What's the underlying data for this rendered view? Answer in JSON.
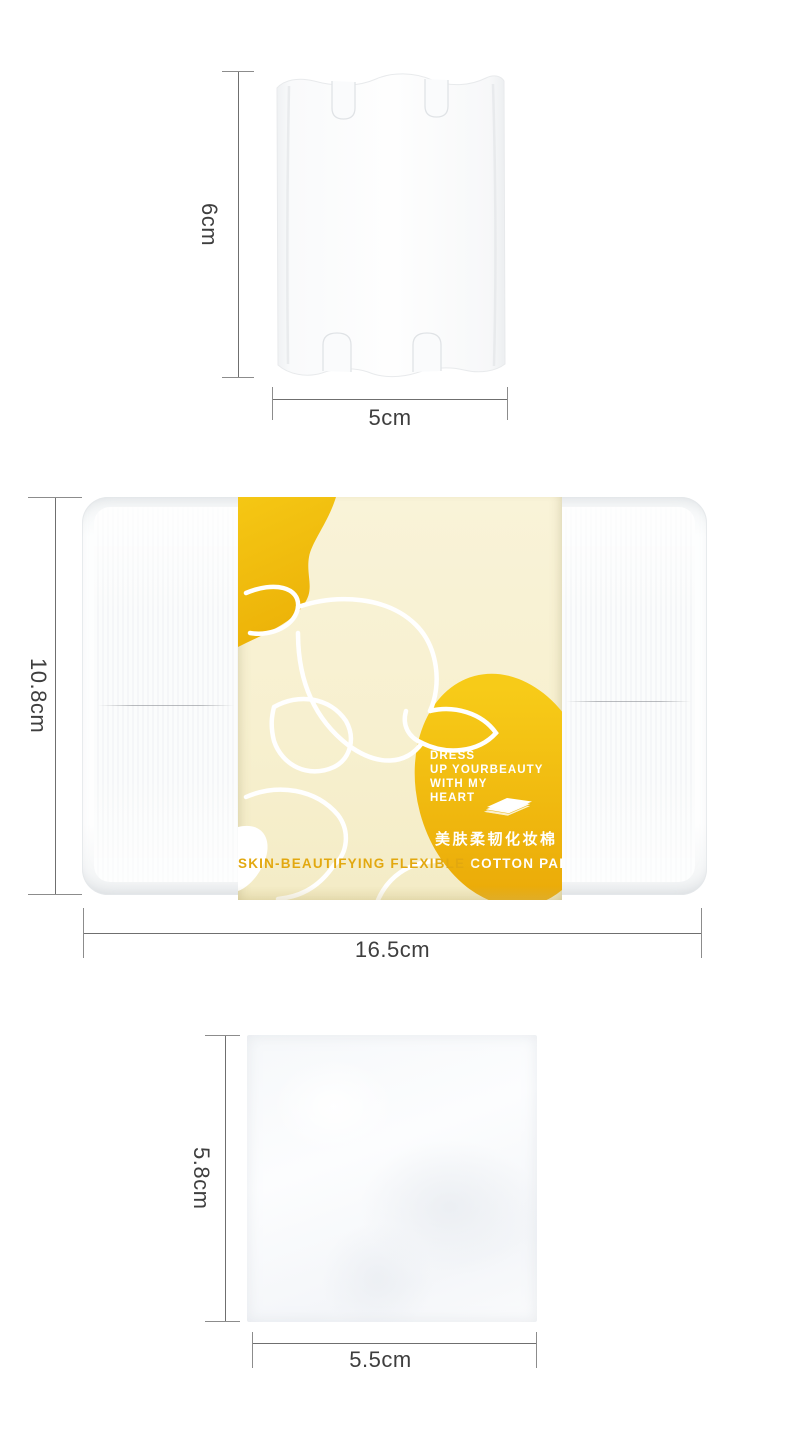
{
  "dims": {
    "pad_top_height": "6cm",
    "pad_top_width": "5cm",
    "box_height": "10.8cm",
    "box_width": "16.5cm",
    "pad_bottom_height": "5.8cm",
    "pad_bottom_width": "5.5cm"
  },
  "box_label": {
    "slogan_lines": [
      "DRESS",
      "UP YOURBEAUTY",
      "WITH MY",
      "HEART"
    ],
    "chinese_name": "美肤柔韧化妆棉",
    "product_name": "SKIN-BEAUTIFYING FLEXIBLE COTTON PAD",
    "icons": {
      "pad_stack": "cotton-pad-stack-icon",
      "flower": "flower-line-art"
    }
  },
  "colors": {
    "blob_top": "#F5C714",
    "blob_bottom": "#ECB208",
    "egg_top": "#F7CB18",
    "egg_bottom": "#E9A606",
    "label_cream": "#F8F1D4",
    "gold_text": "#E2A80F",
    "dimension_line": "#6F6F6F",
    "dimension_text": "#3E3E3E"
  }
}
